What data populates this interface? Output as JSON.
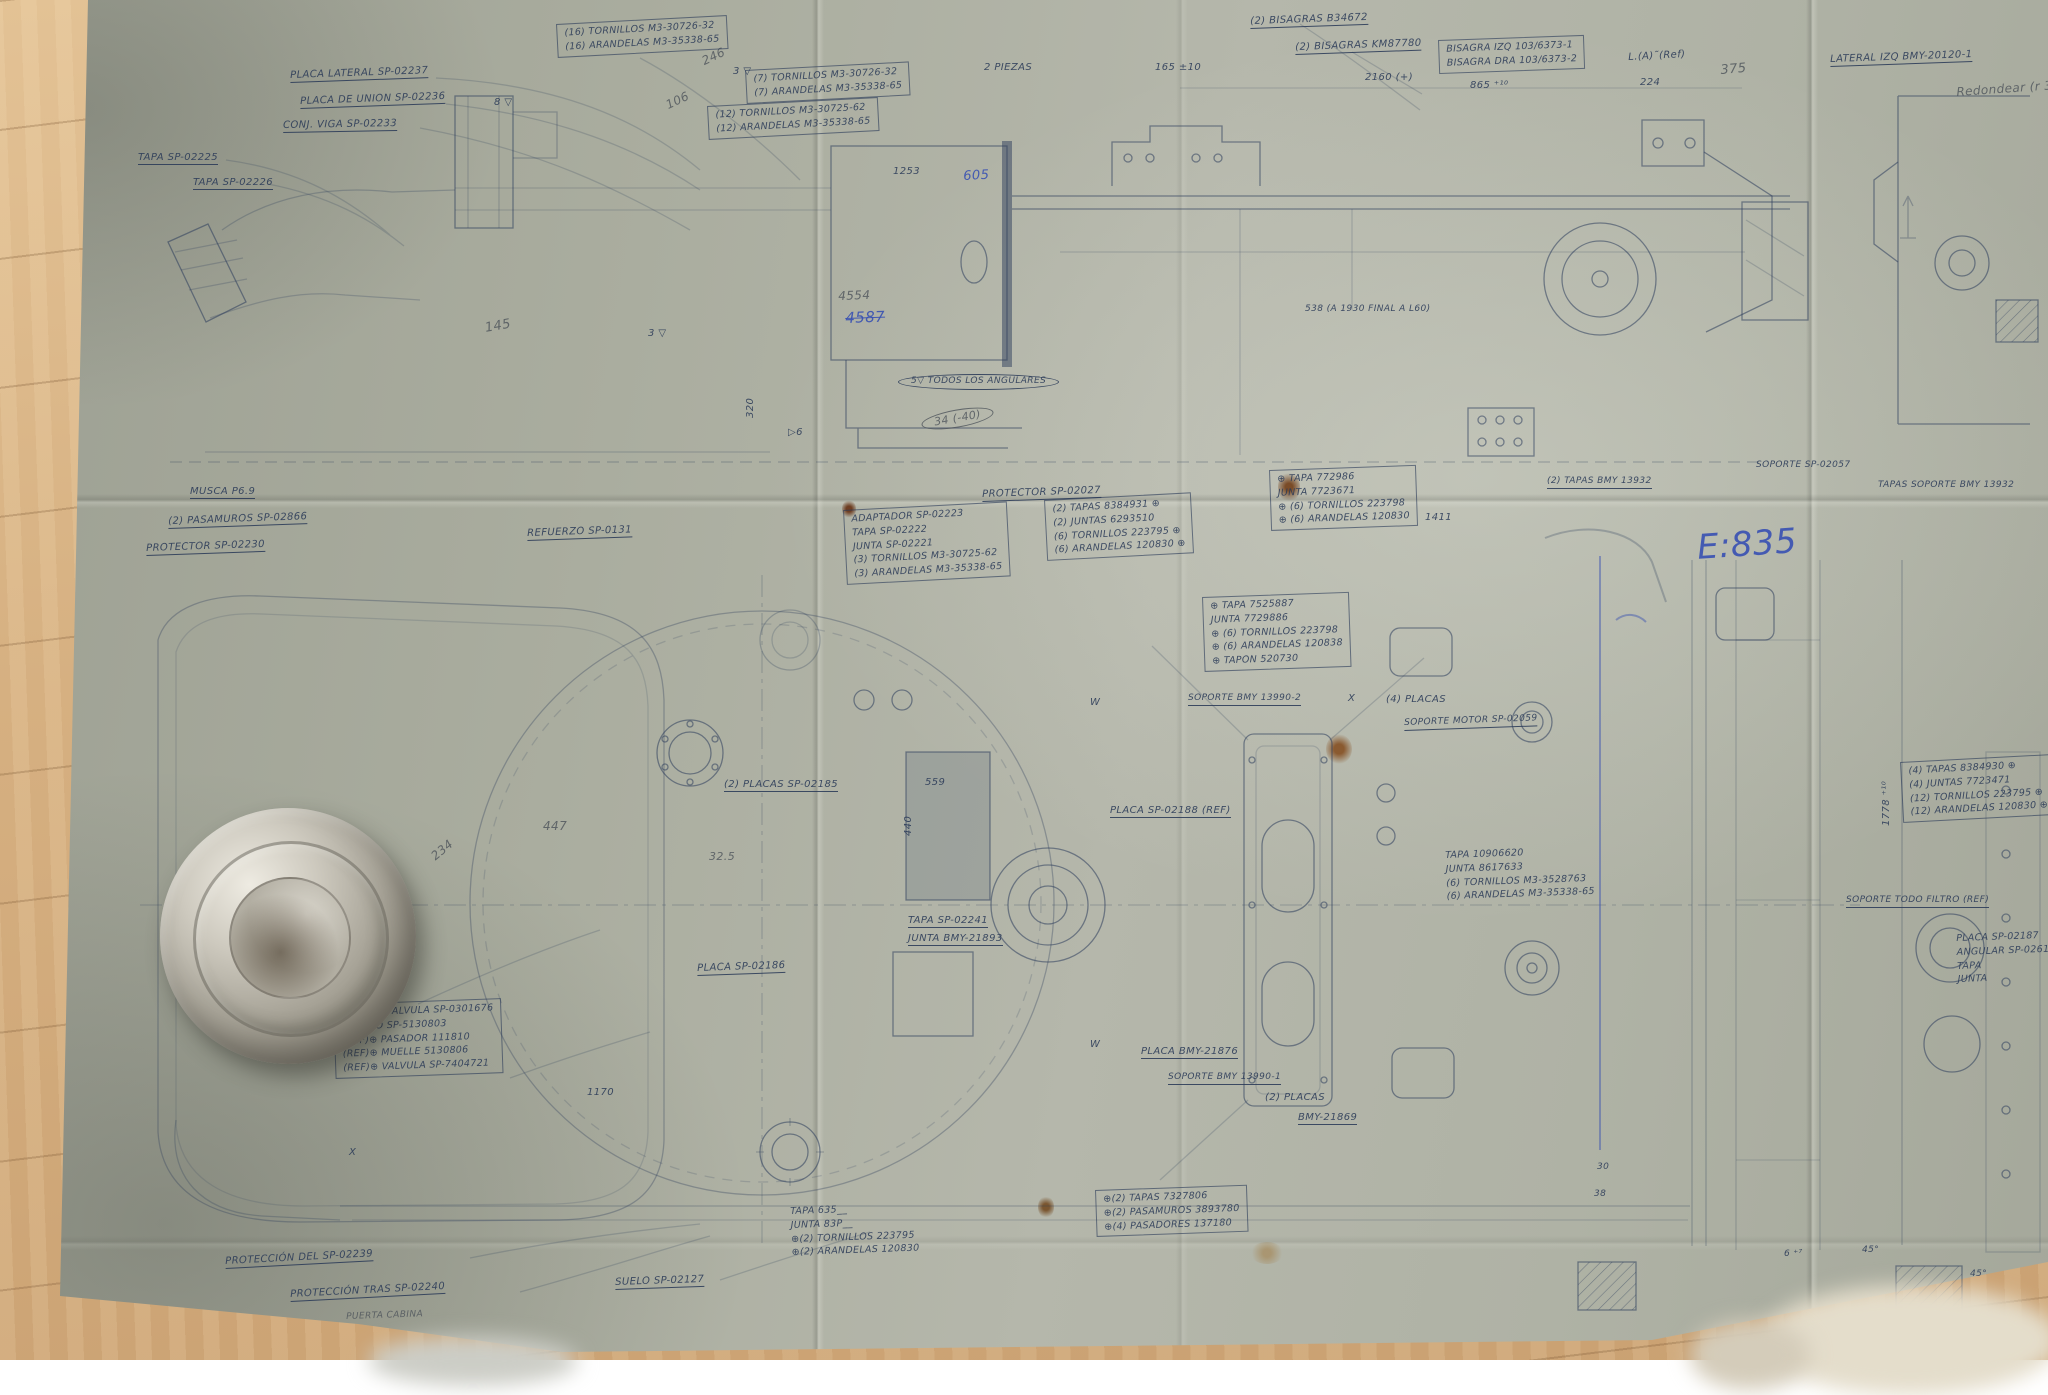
{
  "scene": {
    "paper_color": "#aaad9f",
    "wood_color": "#d6b081",
    "ink_color": "#2a3a58",
    "pencil_color": "#4c525a",
    "blue_ink_color": "#3750b2"
  },
  "handwritten_notes": {
    "scale_note": "E:835",
    "crossed_number": "4587",
    "pencil_numbers": [
      "4554",
      "246",
      "106",
      "145",
      "375",
      "447",
      "234"
    ],
    "blue_numbers": [
      "605"
    ],
    "edge_note": "Redondear (r 3"
  },
  "labels": [
    {
      "t": "PLACA LATERAL SP-02237",
      "x": 290,
      "y": 70,
      "r": -2,
      "st": "u"
    },
    {
      "t": "PLACA DE UNION SP-02236",
      "x": 300,
      "y": 96,
      "r": -2,
      "st": "u"
    },
    {
      "t": "CONJ. VIGA SP-02233",
      "x": 283,
      "y": 120,
      "r": -1,
      "st": "u"
    },
    {
      "t": "TAPA SP-02225",
      "x": 138,
      "y": 152,
      "st": "u"
    },
    {
      "t": "TAPA SP-02226",
      "x": 193,
      "y": 177,
      "st": "u"
    },
    {
      "t": "8 ▽",
      "x": 494,
      "y": 97
    },
    {
      "t": "3 ▽",
      "x": 733,
      "y": 66
    },
    {
      "t": "2 PIEZAS",
      "x": 984,
      "y": 62
    },
    {
      "t": "(2) BISAGRAS B34672",
      "x": 1250,
      "y": 16,
      "r": -2,
      "st": "u"
    },
    {
      "t": "(2) BISAGRAS KM87780",
      "x": 1295,
      "y": 42,
      "r": -2,
      "st": "u"
    },
    {
      "t": "LATERAL IZQ BMY-20120-1",
      "x": 1830,
      "y": 54,
      "r": -2,
      "st": "u"
    },
    {
      "t": "Redondear (r 3",
      "x": 1956,
      "y": 86,
      "r": -4,
      "s": 12,
      "c": "pencil"
    },
    {
      "t": "L.(A)˜(Ref)",
      "x": 1628,
      "y": 52,
      "r": -3
    },
    {
      "t": "2160 (+)",
      "x": 1365,
      "y": 72
    },
    {
      "t": "865 ⁺¹⁰",
      "x": 1470,
      "y": 80
    },
    {
      "t": "224",
      "x": 1640,
      "y": 77
    },
    {
      "t": "375",
      "x": 1720,
      "y": 64,
      "r": -5,
      "s": 13,
      "c": "pencil"
    },
    {
      "t": "165 ±10",
      "x": 1155,
      "y": 62
    },
    {
      "t": "1253",
      "x": 893,
      "y": 166
    },
    {
      "t": "605",
      "x": 963,
      "y": 170,
      "r": -3,
      "s": 13,
      "c": "blue"
    },
    {
      "t": "4554",
      "x": 838,
      "y": 290,
      "r": -2,
      "s": 12,
      "c": "pencil"
    },
    {
      "t": "4587",
      "x": 845,
      "y": 310,
      "r": -2,
      "s": 15,
      "c": "blue",
      "st": "strike"
    },
    {
      "t": "145",
      "x": 484,
      "y": 322,
      "r": -10,
      "s": 13,
      "c": "pencil"
    },
    {
      "t": "246",
      "x": 700,
      "y": 56,
      "r": -25,
      "s": 12,
      "c": "pencil"
    },
    {
      "t": "106",
      "x": 664,
      "y": 100,
      "r": -25,
      "s": 12,
      "c": "pencil"
    },
    {
      "t": "538 (A 1930 FINAL A L60)",
      "x": 1305,
      "y": 305,
      "s": 9
    },
    {
      "t": "5▽ TODOS LOS ANGULARES",
      "x": 898,
      "y": 374,
      "s": 9,
      "st": "b"
    },
    {
      "t": "34 (-40)",
      "x": 920,
      "y": 416,
      "r": -10,
      "s": 11,
      "c": "pencil",
      "st": "b"
    },
    {
      "t": "320",
      "x": 745,
      "y": 418,
      "r": -90
    },
    {
      "t": "▷6",
      "x": 788,
      "y": 427
    },
    {
      "t": "3 ▽",
      "x": 648,
      "y": 328
    },
    {
      "t": "MUSCA P6.9",
      "x": 190,
      "y": 486,
      "st": "u"
    },
    {
      "t": "(2) PASAMUROS SP-02866",
      "x": 168,
      "y": 516,
      "r": -2,
      "st": "u"
    },
    {
      "t": "PROTECTOR SP-02230",
      "x": 146,
      "y": 543,
      "r": -2,
      "st": "u"
    },
    {
      "t": "REFUERZO SP-0131",
      "x": 527,
      "y": 528,
      "r": -2,
      "st": "u"
    },
    {
      "t": "PROTECTOR SP-02027",
      "x": 982,
      "y": 489,
      "r": -2,
      "st": "u"
    },
    {
      "t": "SOPORTE SP-02057",
      "x": 1756,
      "y": 461,
      "s": 9
    },
    {
      "t": "TAPAS SOPORTE BMY 13932",
      "x": 1878,
      "y": 481,
      "s": 9
    },
    {
      "t": "(2) TAPAS BMY 13932",
      "x": 1547,
      "y": 477,
      "s": 9,
      "st": "u"
    },
    {
      "t": "E:835",
      "x": 1696,
      "y": 530,
      "r": -4,
      "s": 34,
      "c": "blue"
    },
    {
      "t": "1411",
      "x": 1425,
      "y": 512
    },
    {
      "t": "SOPORTE BMY 13990-2",
      "x": 1188,
      "y": 694,
      "s": 9,
      "st": "u"
    },
    {
      "t": "(4) PLACAS",
      "x": 1386,
      "y": 694
    },
    {
      "t": "SOPORTE MOTOR SP-02059",
      "x": 1404,
      "y": 719,
      "r": -2,
      "s": 9,
      "st": "u"
    },
    {
      "t": "(2) PLACAS SP-02185",
      "x": 724,
      "y": 779,
      "st": "u"
    },
    {
      "t": "PLACA SP-02188 (REF)",
      "x": 1110,
      "y": 805,
      "st": "u"
    },
    {
      "t": "W",
      "x": 1090,
      "y": 697
    },
    {
      "t": "W",
      "x": 1090,
      "y": 1039
    },
    {
      "t": "559",
      "x": 925,
      "y": 777
    },
    {
      "t": "447",
      "x": 543,
      "y": 820,
      "s": 12,
      "c": "pencil"
    },
    {
      "t": "234",
      "x": 429,
      "y": 853,
      "r": -40,
      "s": 12,
      "c": "pencil"
    },
    {
      "t": "32.5",
      "x": 709,
      "y": 851,
      "s": 11,
      "c": "pencil"
    },
    {
      "t": "440",
      "x": 903,
      "y": 836,
      "r": -90
    },
    {
      "t": "TAPA SP-02241",
      "x": 908,
      "y": 915,
      "st": "u"
    },
    {
      "t": "JUNTA BMY-21893",
      "x": 908,
      "y": 933,
      "st": "u"
    },
    {
      "t": "PLACA SP-02186",
      "x": 697,
      "y": 963,
      "r": -2,
      "st": "u"
    },
    {
      "t": "PLACA BMY-21876",
      "x": 1141,
      "y": 1046,
      "st": "u"
    },
    {
      "t": "SOPORTE BMY 13990-1",
      "x": 1168,
      "y": 1073,
      "s": 9,
      "st": "u"
    },
    {
      "t": "(2) PLACAS",
      "x": 1265,
      "y": 1092
    },
    {
      "t": "BMY-21869",
      "x": 1298,
      "y": 1112,
      "st": "u"
    },
    {
      "t": "SOPORTE TODO FILTRO (REF)",
      "x": 1846,
      "y": 896,
      "s": 9,
      "st": "u"
    },
    {
      "t": "1170",
      "x": 587,
      "y": 1087
    },
    {
      "t": "X",
      "x": 349,
      "y": 1147
    },
    {
      "t": "X",
      "x": 1348,
      "y": 693
    },
    {
      "t": "1778 ⁺¹⁰",
      "x": 1881,
      "y": 826,
      "r": -90
    },
    {
      "t": "30",
      "x": 1597,
      "y": 1163,
      "s": 9
    },
    {
      "t": "38",
      "x": 1594,
      "y": 1190,
      "s": 9
    },
    {
      "t": "6 ⁺⁷",
      "x": 1784,
      "y": 1250,
      "s": 9
    },
    {
      "t": "45°",
      "x": 1862,
      "y": 1246,
      "s": 9
    },
    {
      "t": "45°",
      "x": 1970,
      "y": 1270,
      "s": 9
    },
    {
      "t": "PROTECCIÓN DEL SP-02239",
      "x": 225,
      "y": 1256,
      "r": -3,
      "st": "u"
    },
    {
      "t": "PROTECCIÓN TRAS SP-02240",
      "x": 290,
      "y": 1289,
      "r": -3,
      "st": "u"
    },
    {
      "t": "SUELO SP-02127",
      "x": 615,
      "y": 1277,
      "r": -2,
      "st": "u"
    },
    {
      "t": "PUERTA CABINA",
      "x": 346,
      "y": 1313,
      "r": -2,
      "s": 9,
      "c": "pencil"
    }
  ],
  "part_boxes": [
    {
      "x": 556,
      "y": 24,
      "r": -3,
      "boxed": true,
      "lines": [
        "(16) TORNILLOS  M3-30726-32",
        "(16) ARANDELAS  M3-35338-65"
      ]
    },
    {
      "x": 745,
      "y": 70,
      "r": -3,
      "boxed": true,
      "lines": [
        "(7) TORNILLOS  M3-30726-32",
        "(7) ARANDELAS  M3-35338-65"
      ]
    },
    {
      "x": 707,
      "y": 106,
      "r": -3,
      "boxed": true,
      "lines": [
        "(12) TORNILLOS  M3-30725-62",
        "(12) ARANDELAS  M3-35338-65"
      ]
    },
    {
      "x": 1438,
      "y": 40,
      "r": -2,
      "boxed": true,
      "lines": [
        "BISAGRA IZQ 103/6373-1",
        "BISAGRA DRA 103/6373-2"
      ]
    },
    {
      "x": 843,
      "y": 510,
      "r": -3,
      "boxed": true,
      "lines": [
        "ADAPTADOR  SP-02223",
        "TAPA  SP-02222",
        "JUNTA  SP-02221",
        "(3) TORNILLOS  M3-30725-62",
        "(3) ARANDELAS  M3-35338-65"
      ]
    },
    {
      "x": 1044,
      "y": 500,
      "r": -3,
      "boxed": true,
      "lines": [
        "(2) TAPAS  8384931 ⊕",
        "(2) JUNTAS  6293510",
        "(6) TORNILLOS  223795 ⊕",
        "(6) ARANDELAS  120830 ⊕"
      ]
    },
    {
      "x": 1269,
      "y": 470,
      "r": -2,
      "boxed": true,
      "lines": [
        "⊕ TAPA  772986",
        "JUNTA  7723671",
        "⊕ (6) TORNILLOS  223798",
        "⊕ (6) ARANDELAS  120830"
      ]
    },
    {
      "x": 1202,
      "y": 597,
      "r": -2,
      "boxed": true,
      "lines": [
        "⊕ TAPA  7525887",
        "JUNTA  7729886",
        "⊕ (6) TORNILLOS  223798",
        "⊕ (6) ARANDELAS  120838",
        "⊕ TAPON  520730"
      ]
    },
    {
      "x": 1900,
      "y": 762,
      "r": -3,
      "boxed": true,
      "lines": [
        "(4) TAPAS  8384930 ⊕",
        "(4) JUNTAS  7723471",
        "(12) TORNILLOS  223795 ⊕",
        "(12) ARANDELAS  120830 ⊕"
      ]
    },
    {
      "x": 1445,
      "y": 849,
      "r": -2,
      "boxed": false,
      "lines": [
        "TAPA  10906620",
        "JUNTA  8617633",
        "(6) TORNILLOS  M3-3528763",
        "(6) ARANDELAS  M3-35338-65"
      ]
    },
    {
      "x": 1095,
      "y": 1190,
      "r": -2,
      "boxed": true,
      "lines": [
        "⊕(2) TAPAS  7327806",
        "⊕(2) PASAMUROS  3893780",
        "⊕(4) PASADORES  137180"
      ]
    },
    {
      "x": 333,
      "y": 1004,
      "r": -2,
      "boxed": true,
      "lines": [
        "CUERPO VALVULA SP-0301676",
        "⊕ POMO  SP-5130803",
        "(REF)⊕ PASADOR  111810",
        "(REF)⊕ MUELLE  5130806",
        "(REF)⊕ VALVULA  SP-7404721"
      ]
    },
    {
      "x": 790,
      "y": 1205,
      "r": -2,
      "boxed": false,
      "lines": [
        "TAPA 635__",
        "JUNTA 83P__",
        "⊕(2) TORNILLOS  223795",
        "⊕(2) ARANDELAS  120830"
      ]
    },
    {
      "x": 1956,
      "y": 932,
      "r": -2,
      "boxed": false,
      "lines": [
        "PLACA  SP-02187",
        "ANGULAR  SP-02616",
        "TAPA",
        "JUNTA"
      ]
    }
  ]
}
